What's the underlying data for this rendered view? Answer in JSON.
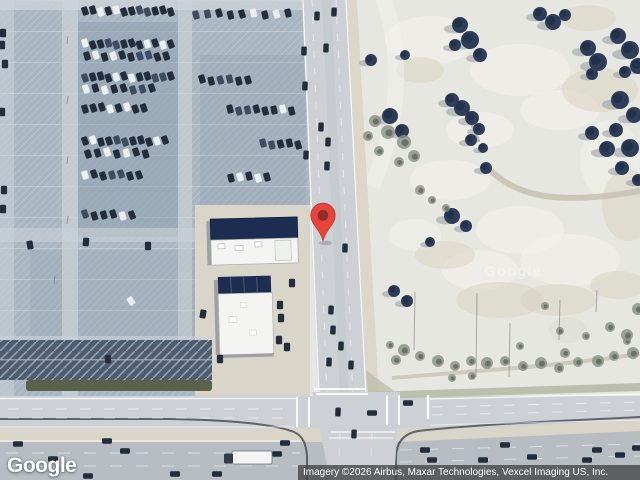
{
  "branding": {
    "logo_text": "Google",
    "watermark_text": "Google"
  },
  "attribution": {
    "text": "Imagery ©2026 Airbus, Maxar Technologies, Vexcel Imaging US, Inc."
  },
  "marker": {
    "x": 323,
    "y": 241,
    "width": 28,
    "height": 40,
    "color": "#E7453C",
    "border_color": "#C03A30",
    "inner_color": "#8E2F27"
  },
  "map": {
    "colors": {
      "lot": "#aab7c2",
      "lotShade": "#8b9dae",
      "lotAisle": "#ccd3d8",
      "stripeZone": "#4e5d70",
      "hedge": "#59614b",
      "road": "#cdd1d5",
      "highway": "#b7bdc3",
      "median": "#d9d5c9",
      "curb": "#41484f",
      "field": "#e7e7e1",
      "fieldPatch": "#f4f3ed",
      "fieldTan": "#d8d1bf",
      "tree": "#2e3d59",
      "treeDark": "#202d45",
      "scrub": "#8a9084",
      "scrubDark": "#5f675c",
      "shadow": "#8f969b",
      "buildingNavy": "#1c2d51",
      "buildingWhite": "#f4f5f2",
      "carDark": "#242d3c",
      "carMid": "#3e4c62",
      "carLight": "#eceef0",
      "trail": "#c7c3b5",
      "verge": "#b6baa6"
    },
    "parking_rows": [
      {
        "y": 11,
        "x0": 85,
        "n": 12,
        "dx": 7.8,
        "r": -18,
        "s": 1
      },
      {
        "y": 14,
        "x0": 196,
        "n": 9,
        "dx": 11.5,
        "r": -15,
        "s": 2
      },
      {
        "y": 44,
        "x0": 85,
        "n": 12,
        "dx": 7.8,
        "r": -18,
        "s": 3
      },
      {
        "y": 56,
        "x0": 87,
        "n": 10,
        "dx": 8.8,
        "r": -18,
        "s": 4
      },
      {
        "y": 77,
        "x0": 85,
        "n": 12,
        "dx": 7.8,
        "r": -18,
        "s": 5
      },
      {
        "y": 80,
        "x0": 202,
        "n": 6,
        "dx": 9.2,
        "r": -15,
        "s": 6
      },
      {
        "y": 89,
        "x0": 86,
        "n": 8,
        "dx": 9.4,
        "r": -18,
        "s": 7
      },
      {
        "y": 108,
        "x0": 85,
        "n": 8,
        "dx": 8.4,
        "r": -18,
        "s": 8
      },
      {
        "y": 110,
        "x0": 230,
        "n": 8,
        "dx": 8.8,
        "r": -15,
        "s": 9
      },
      {
        "y": 141,
        "x0": 85,
        "n": 11,
        "dx": 8.0,
        "r": -18,
        "s": 10
      },
      {
        "y": 153,
        "x0": 88,
        "n": 7,
        "dx": 9.6,
        "r": -18,
        "s": 11
      },
      {
        "y": 144,
        "x0": 263,
        "n": 5,
        "dx": 8.8,
        "r": -15,
        "s": 12
      },
      {
        "y": 175,
        "x0": 85,
        "n": 7,
        "dx": 9.0,
        "r": -18,
        "s": 13
      },
      {
        "y": 177,
        "x0": 231,
        "n": 5,
        "dx": 9.0,
        "r": -15,
        "s": 14
      },
      {
        "y": 215,
        "x0": 85,
        "n": 6,
        "dx": 9.4,
        "r": -18,
        "s": 15
      }
    ],
    "parked_cars": [
      [
        30,
        245,
        -10
      ],
      [
        86,
        242,
        5
      ],
      [
        148,
        246,
        0
      ],
      [
        131,
        301,
        -35,
        "l"
      ],
      [
        203,
        314,
        10
      ],
      [
        280,
        305,
        0
      ],
      [
        281,
        318,
        0
      ],
      [
        279,
        340,
        0
      ],
      [
        292,
        283,
        0
      ],
      [
        287,
        347,
        0
      ],
      [
        3,
        33,
        0
      ],
      [
        2,
        45,
        0
      ],
      [
        5,
        64,
        0
      ],
      [
        2,
        112,
        0
      ],
      [
        4,
        190,
        0
      ],
      [
        3,
        209,
        0
      ],
      [
        220,
        359,
        0
      ],
      [
        108,
        359,
        0
      ]
    ],
    "road_cars_vertical": [
      [
        317,
        16
      ],
      [
        334,
        12
      ],
      [
        326,
        48
      ],
      [
        304,
        51
      ],
      [
        305,
        86
      ],
      [
        321,
        127
      ],
      [
        328,
        142
      ],
      [
        306,
        155
      ],
      [
        327,
        166
      ],
      [
        345,
        248
      ],
      [
        331,
        310
      ],
      [
        333,
        330
      ],
      [
        329,
        362
      ],
      [
        341,
        346
      ],
      [
        351,
        365
      ],
      [
        338,
        412
      ],
      [
        354,
        434
      ]
    ],
    "highway_cars": [
      [
        18,
        444
      ],
      [
        53,
        459
      ],
      [
        88,
        476
      ],
      [
        107,
        441
      ],
      [
        125,
        451
      ],
      [
        175,
        474
      ],
      [
        217,
        474
      ],
      [
        277,
        454
      ],
      [
        285,
        443
      ],
      [
        372,
        413
      ],
      [
        408,
        403
      ],
      [
        425,
        450
      ],
      [
        432,
        460
      ],
      [
        483,
        460
      ],
      [
        505,
        445
      ],
      [
        532,
        457
      ],
      [
        587,
        460
      ],
      [
        597,
        450
      ],
      [
        620,
        455
      ],
      [
        637,
        448
      ]
    ],
    "truck": {
      "x": 224,
      "y": 451,
      "trailer_w": 40,
      "trailer_h": 13
    },
    "trees": [
      [
        460,
        25,
        8,
        "t"
      ],
      [
        470,
        40,
        9,
        "t"
      ],
      [
        480,
        55,
        7,
        "t"
      ],
      [
        455,
        45,
        6,
        "t"
      ],
      [
        405,
        55,
        5,
        "t"
      ],
      [
        540,
        14,
        7,
        "t"
      ],
      [
        553,
        22,
        8,
        "t"
      ],
      [
        565,
        15,
        6,
        "t"
      ],
      [
        588,
        48,
        8,
        "t"
      ],
      [
        598,
        62,
        9,
        "t"
      ],
      [
        592,
        74,
        6,
        "t"
      ],
      [
        618,
        36,
        8,
        "t"
      ],
      [
        630,
        50,
        9,
        "t"
      ],
      [
        638,
        66,
        8,
        "t"
      ],
      [
        625,
        72,
        6,
        "t"
      ],
      [
        620,
        100,
        9,
        "t"
      ],
      [
        634,
        115,
        8,
        "t"
      ],
      [
        616,
        130,
        7,
        "t"
      ],
      [
        630,
        148,
        9,
        "t"
      ],
      [
        622,
        168,
        7,
        "t"
      ],
      [
        638,
        180,
        6,
        "t"
      ],
      [
        592,
        133,
        7,
        "t"
      ],
      [
        607,
        149,
        8,
        "t"
      ],
      [
        452,
        100,
        7,
        "t"
      ],
      [
        462,
        108,
        8,
        "t"
      ],
      [
        472,
        118,
        7,
        "t"
      ],
      [
        479,
        129,
        6,
        "t"
      ],
      [
        471,
        140,
        6,
        "t"
      ],
      [
        483,
        148,
        5,
        "t"
      ],
      [
        486,
        168,
        6,
        "t"
      ],
      [
        371,
        60,
        6,
        "t"
      ],
      [
        390,
        116,
        8,
        "t"
      ],
      [
        402,
        131,
        7,
        "t"
      ],
      [
        452,
        216,
        8,
        "t"
      ],
      [
        466,
        226,
        6,
        "t"
      ],
      [
        430,
        242,
        5,
        "t"
      ],
      [
        394,
        291,
        6,
        "t"
      ],
      [
        407,
        301,
        6,
        "t"
      ],
      [
        375,
        121,
        6,
        "s"
      ],
      [
        388,
        132,
        7,
        "s"
      ],
      [
        404,
        142,
        7,
        "s"
      ],
      [
        414,
        156,
        6,
        "s"
      ],
      [
        399,
        162,
        5,
        "s"
      ],
      [
        379,
        151,
        5,
        "s"
      ],
      [
        368,
        136,
        5,
        "s"
      ],
      [
        420,
        190,
        5,
        "s"
      ],
      [
        432,
        200,
        4,
        "s"
      ],
      [
        446,
        208,
        4,
        "s"
      ],
      [
        404,
        350,
        6,
        "s"
      ],
      [
        420,
        356,
        5,
        "s"
      ],
      [
        438,
        361,
        6,
        "s"
      ],
      [
        455,
        366,
        5,
        "s"
      ],
      [
        471,
        361,
        5,
        "s"
      ],
      [
        487,
        363,
        6,
        "s"
      ],
      [
        505,
        361,
        5,
        "s"
      ],
      [
        523,
        366,
        5,
        "s"
      ],
      [
        541,
        363,
        6,
        "s"
      ],
      [
        559,
        368,
        5,
        "s"
      ],
      [
        578,
        362,
        5,
        "s"
      ],
      [
        598,
        361,
        6,
        "s"
      ],
      [
        614,
        356,
        5,
        "s"
      ],
      [
        633,
        353,
        6,
        "s"
      ],
      [
        452,
        378,
        4,
        "s"
      ],
      [
        472,
        376,
        4,
        "s"
      ],
      [
        520,
        346,
        4,
        "s"
      ],
      [
        560,
        331,
        4,
        "s"
      ],
      [
        586,
        336,
        4,
        "s"
      ],
      [
        610,
        327,
        5,
        "s"
      ],
      [
        627,
        341,
        4,
        "s"
      ],
      [
        545,
        306,
        4,
        "s"
      ],
      [
        565,
        353,
        5,
        "s"
      ],
      [
        638,
        309,
        6,
        "s"
      ],
      [
        627,
        335,
        6,
        "s"
      ],
      [
        396,
        360,
        5,
        "s"
      ],
      [
        390,
        345,
        4,
        "s"
      ]
    ],
    "poles": [
      [
        415,
        292,
        350
      ],
      [
        477,
        293,
        377
      ],
      [
        510,
        323,
        377
      ],
      [
        597,
        290,
        312
      ],
      [
        560,
        300,
        340
      ],
      [
        68,
        36,
        44
      ],
      [
        68,
        96,
        104
      ],
      [
        68,
        156,
        164
      ],
      [
        68,
        216,
        224
      ],
      [
        55,
        276,
        284
      ]
    ]
  }
}
